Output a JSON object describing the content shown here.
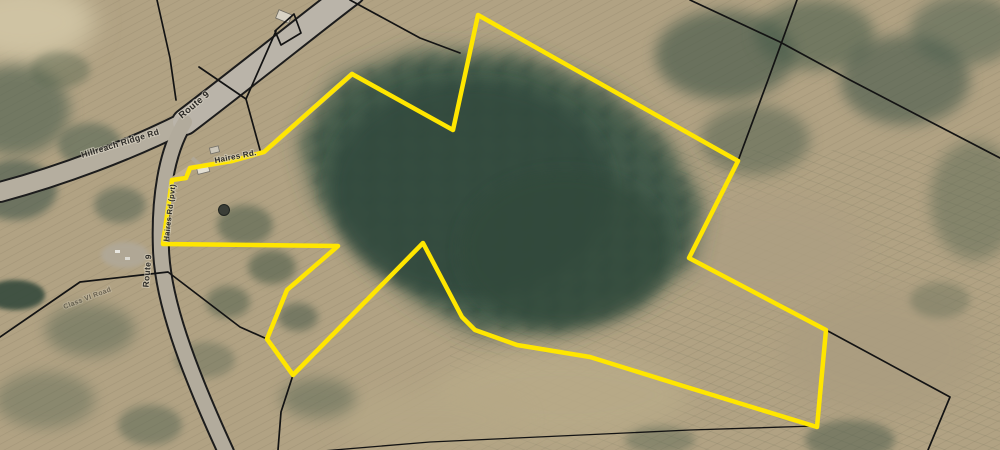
{
  "map": {
    "description": "Aerial imagery parcel map with one property highlighted in yellow",
    "road_labels": {
      "route9_upper": "Route 9",
      "route9_lower": "Route 9",
      "ridge_rd": "Hillreach Ridge Rd",
      "haires_rd": "Haires Rd.",
      "haires_rd_pvt": "Haires Rd (pvt)",
      "class_vi": "Class VI Road"
    },
    "colors": {
      "highlight": "#ffe600",
      "parcel_line": "#131313",
      "road_fill": "#b7b1a4",
      "field": "#b3a584",
      "forest": "#3d5647"
    },
    "highlight_boundary": {
      "stroke_width": 4.5,
      "vertices": [
        [
          478,
          15
        ],
        [
          738,
          161
        ],
        [
          689,
          258
        ],
        [
          826,
          330
        ],
        [
          817,
          427
        ],
        [
          680,
          385
        ],
        [
          590,
          357
        ],
        [
          517,
          345
        ],
        [
          475,
          330
        ],
        [
          462,
          317
        ],
        [
          423,
          243
        ],
        [
          293,
          375
        ],
        [
          267,
          339
        ],
        [
          287,
          290
        ],
        [
          338,
          246
        ],
        [
          163,
          244
        ],
        [
          172,
          180
        ],
        [
          186,
          178
        ],
        [
          190,
          168
        ],
        [
          232,
          161
        ],
        [
          264,
          152
        ],
        [
          300,
          120
        ],
        [
          352,
          74
        ],
        [
          453,
          130
        ]
      ]
    },
    "parcel_lines": [
      [
        [
          157,
          0
        ],
        [
          170,
          58
        ],
        [
          176,
          100
        ]
      ],
      [
        [
          350,
          0
        ],
        [
          420,
          38
        ],
        [
          460,
          53
        ]
      ],
      [
        [
          797,
          0
        ],
        [
          768,
          80
        ],
        [
          738,
          161
        ]
      ],
      [
        [
          690,
          0
        ],
        [
          780,
          42
        ],
        [
          850,
          80
        ],
        [
          1000,
          158
        ]
      ],
      [
        [
          826,
          330
        ],
        [
          950,
          397
        ],
        [
          928,
          450
        ]
      ],
      [
        [
          293,
          375
        ],
        [
          281,
          412
        ],
        [
          278,
          450
        ]
      ],
      [
        [
          0,
          337
        ],
        [
          80,
          282
        ],
        [
          168,
          272
        ],
        [
          240,
          327
        ],
        [
          267,
          339
        ]
      ],
      [
        [
          199,
          67
        ],
        [
          246,
          99
        ],
        [
          276,
          31
        ]
      ],
      [
        [
          246,
          99
        ],
        [
          260,
          150
        ]
      ],
      [
        [
          275,
          31
        ],
        [
          294,
          14
        ],
        [
          301,
          33
        ],
        [
          281,
          45
        ],
        [
          275,
          31
        ]
      ],
      [
        [
          310,
          452
        ],
        [
          430,
          442
        ],
        [
          560,
          436
        ],
        [
          690,
          430
        ],
        [
          815,
          426
        ]
      ]
    ]
  }
}
